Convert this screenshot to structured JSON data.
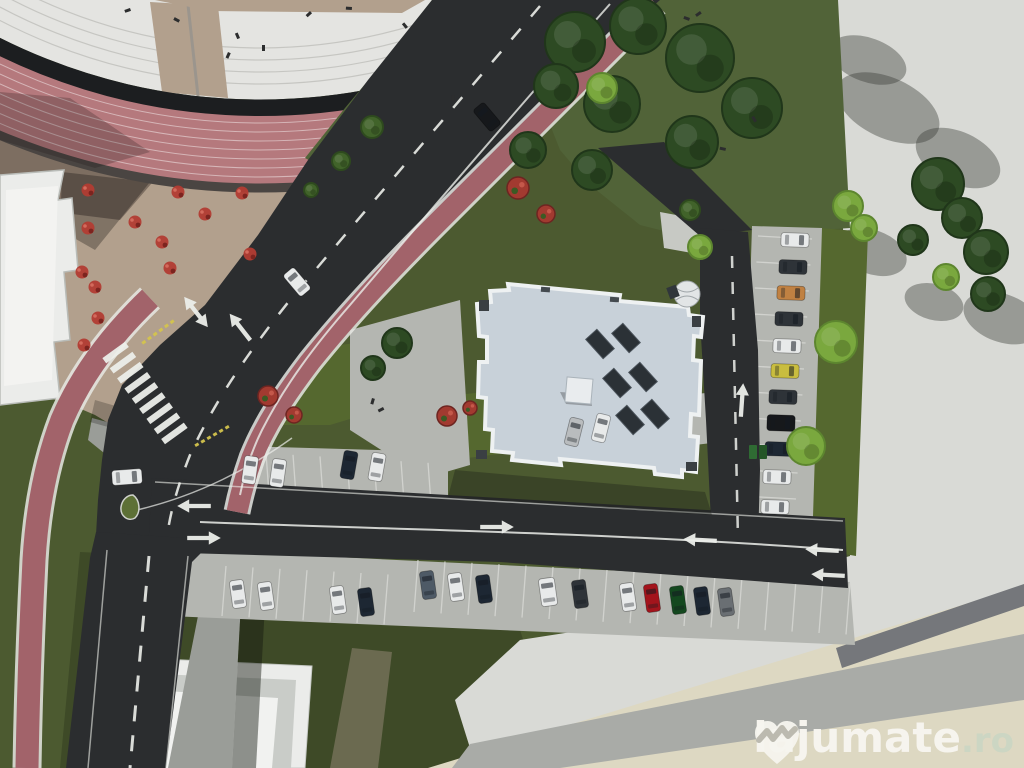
{
  "watermark": {
    "brand": "lajumate",
    "tld": ".ro",
    "logo": "heart-zigzag-icon"
  },
  "palette": {
    "base_grass": "#4c5a30",
    "lawn_dark": "#3e4a27",
    "grass_mid": "#55682f",
    "grass_strip": "#516338",
    "tree_dark": "#2d4a23",
    "tree_mid": "#41632a",
    "tree_light": "#7aa83e",
    "bush_red": "#a23a30",
    "road": "#2b2d2f",
    "bike_red": "#a2636a",
    "track_pink": "#b5797d",
    "track_line": "#d6b6b8",
    "tan": "#b2a08d",
    "steps_white": "#e4e4e1",
    "step_line": "#c6c6c2",
    "ring_black": "#1c1e20",
    "curb": "#4a4542",
    "paving": "#b4b6b1",
    "paving_light": "#c7c9c4",
    "sidewalk": "#9a9d98",
    "concrete": "#d9dad6",
    "cream": "#ddd8c2",
    "band_gray": "#a9aba7",
    "band_dark": "#75777b",
    "bldg_white": "#ebecea",
    "bldg_frame": "#c9ccc8",
    "roof": "#c8d1d9",
    "roof_edge": "#eef1f2",
    "panel": "#2b3136",
    "mark_white": "#eceeea",
    "mark_yellow": "#d4c44d",
    "car_white": "#e8eaea",
    "car_silver": "#b9bcbe",
    "car_black": "#16181b",
    "car_charcoal": "#2e3338",
    "car_navy": "#1d2733",
    "car_steel": "#4e5a66",
    "car_red": "#a3141c",
    "car_green": "#14481f",
    "car_gray": "#6a6f73",
    "car_yellow": "#c9bd3f",
    "car_orange": "#c08142",
    "wm_white": "#f6f4ee",
    "wm_ro": "#ccd6c3"
  },
  "scene": {
    "vehicles": [
      {
        "x": 297,
        "y": 282,
        "rot": -40,
        "color": "car_white"
      },
      {
        "x": 487,
        "y": 117,
        "rot": -40,
        "color": "car_black"
      },
      {
        "x": 127,
        "y": 477,
        "rot": 86,
        "color": "car_white",
        "len": 30,
        "wid": 15
      },
      {
        "x": 250,
        "y": 470,
        "rot": 8,
        "color": "car_white"
      },
      {
        "x": 278,
        "y": 473,
        "rot": 8,
        "color": "car_white"
      },
      {
        "x": 349,
        "y": 465,
        "rot": 10,
        "color": "car_navy"
      },
      {
        "x": 377,
        "y": 467,
        "rot": 10,
        "color": "car_white"
      },
      {
        "x": 574,
        "y": 432,
        "rot": 14,
        "color": "car_silver"
      },
      {
        "x": 601,
        "y": 428,
        "rot": 14,
        "color": "car_white"
      },
      {
        "x": 238,
        "y": 594,
        "rot": -8,
        "color": "car_white"
      },
      {
        "x": 266,
        "y": 596,
        "rot": -8,
        "color": "car_white"
      },
      {
        "x": 338,
        "y": 600,
        "rot": -8,
        "color": "car_white"
      },
      {
        "x": 366,
        "y": 602,
        "rot": -8,
        "color": "car_navy"
      },
      {
        "x": 428,
        "y": 585,
        "rot": -8,
        "color": "car_steel"
      },
      {
        "x": 456,
        "y": 587,
        "rot": -8,
        "color": "car_white"
      },
      {
        "x": 484,
        "y": 589,
        "rot": -8,
        "color": "car_navy"
      },
      {
        "x": 548,
        "y": 592,
        "rot": -8,
        "color": "car_white",
        "wid": 16
      },
      {
        "x": 580,
        "y": 594,
        "rot": -8,
        "color": "car_charcoal"
      },
      {
        "x": 628,
        "y": 597,
        "rot": -8,
        "color": "car_white"
      },
      {
        "x": 652,
        "y": 598,
        "rot": -8,
        "color": "car_red"
      },
      {
        "x": 678,
        "y": 600,
        "rot": -8,
        "color": "car_green"
      },
      {
        "x": 702,
        "y": 601,
        "rot": -8,
        "color": "car_navy"
      },
      {
        "x": 726,
        "y": 602,
        "rot": -8,
        "color": "car_gray"
      },
      {
        "x": 795,
        "y": 240,
        "rot": 92,
        "color": "car_white"
      },
      {
        "x": 793,
        "y": 267,
        "rot": 92,
        "color": "car_charcoal"
      },
      {
        "x": 791,
        "y": 293,
        "rot": 92,
        "color": "car_orange"
      },
      {
        "x": 789,
        "y": 319,
        "rot": 92,
        "color": "car_charcoal"
      },
      {
        "x": 787,
        "y": 346,
        "rot": 92,
        "color": "car_white"
      },
      {
        "x": 785,
        "y": 371,
        "rot": 92,
        "color": "car_yellow"
      },
      {
        "x": 783,
        "y": 397,
        "rot": 92,
        "color": "car_charcoal"
      },
      {
        "x": 781,
        "y": 423,
        "rot": 92,
        "color": "car_black",
        "wid": 16
      },
      {
        "x": 779,
        "y": 449,
        "rot": 92,
        "color": "car_navy"
      },
      {
        "x": 777,
        "y": 477,
        "rot": 92,
        "color": "car_white"
      },
      {
        "x": 775,
        "y": 507,
        "rot": 92,
        "color": "car_white"
      },
      {
        "x": 758,
        "y": 452,
        "rot": 0,
        "color": "bin"
      }
    ],
    "trees": [
      {
        "x": 575,
        "y": 42,
        "r": 30,
        "shade": "dark"
      },
      {
        "x": 638,
        "y": 26,
        "r": 28,
        "shade": "dark"
      },
      {
        "x": 700,
        "y": 58,
        "r": 34,
        "shade": "dark"
      },
      {
        "x": 752,
        "y": 108,
        "r": 30,
        "shade": "dark"
      },
      {
        "x": 692,
        "y": 142,
        "r": 26,
        "shade": "dark"
      },
      {
        "x": 612,
        "y": 104,
        "r": 28,
        "shade": "dark"
      },
      {
        "x": 556,
        "y": 86,
        "r": 22,
        "shade": "dark"
      },
      {
        "x": 528,
        "y": 150,
        "r": 18,
        "shade": "dark"
      },
      {
        "x": 592,
        "y": 170,
        "r": 20,
        "shade": "dark"
      },
      {
        "x": 938,
        "y": 184,
        "r": 26,
        "shade": "dark"
      },
      {
        "x": 962,
        "y": 218,
        "r": 20,
        "shade": "dark"
      },
      {
        "x": 986,
        "y": 252,
        "r": 22,
        "shade": "dark"
      },
      {
        "x": 913,
        "y": 240,
        "r": 15,
        "shade": "dark"
      },
      {
        "x": 988,
        "y": 294,
        "r": 17,
        "shade": "dark"
      },
      {
        "x": 397,
        "y": 343,
        "r": 15,
        "shade": "dark"
      },
      {
        "x": 373,
        "y": 368,
        "r": 12,
        "shade": "dark"
      },
      {
        "x": 372,
        "y": 127,
        "r": 11,
        "shade": "mid"
      },
      {
        "x": 341,
        "y": 161,
        "r": 9,
        "shade": "mid"
      },
      {
        "x": 311,
        "y": 190,
        "r": 7,
        "shade": "mid"
      },
      {
        "x": 690,
        "y": 210,
        "r": 10,
        "shade": "mid"
      },
      {
        "x": 602,
        "y": 88,
        "r": 15,
        "shade": "light"
      },
      {
        "x": 848,
        "y": 206,
        "r": 15,
        "shade": "light"
      },
      {
        "x": 864,
        "y": 228,
        "r": 13,
        "shade": "light"
      },
      {
        "x": 836,
        "y": 342,
        "r": 21,
        "shade": "light"
      },
      {
        "x": 806,
        "y": 446,
        "r": 19,
        "shade": "light"
      },
      {
        "x": 700,
        "y": 247,
        "r": 12,
        "shade": "light"
      },
      {
        "x": 946,
        "y": 277,
        "r": 13,
        "shade": "light"
      }
    ],
    "bushes": [
      {
        "x": 518,
        "y": 188,
        "r": 11
      },
      {
        "x": 546,
        "y": 214,
        "r": 9
      },
      {
        "x": 268,
        "y": 396,
        "r": 10
      },
      {
        "x": 294,
        "y": 415,
        "r": 8
      },
      {
        "x": 447,
        "y": 416,
        "r": 10
      },
      {
        "x": 470,
        "y": 408,
        "r": 7
      }
    ],
    "cafe_tables": [
      {
        "x": 88,
        "y": 190
      },
      {
        "x": 178,
        "y": 192
      },
      {
        "x": 242,
        "y": 193
      },
      {
        "x": 135,
        "y": 222
      },
      {
        "x": 205,
        "y": 214
      },
      {
        "x": 162,
        "y": 242
      },
      {
        "x": 88,
        "y": 228
      },
      {
        "x": 82,
        "y": 272
      },
      {
        "x": 95,
        "y": 287
      },
      {
        "x": 170,
        "y": 268
      },
      {
        "x": 250,
        "y": 254
      },
      {
        "x": 98,
        "y": 318
      },
      {
        "x": 84,
        "y": 345
      }
    ],
    "people": [
      {
        "x": 262,
        "y": 45
      },
      {
        "x": 310,
        "y": 11
      },
      {
        "x": 352,
        "y": 7
      },
      {
        "x": 408,
        "y": 27
      },
      {
        "x": 452,
        "y": 95
      },
      {
        "x": 700,
        "y": 11
      },
      {
        "x": 726,
        "y": 148
      },
      {
        "x": 757,
        "y": 121
      },
      {
        "x": 372,
        "y": 398
      },
      {
        "x": 383,
        "y": 407
      },
      {
        "x": 690,
        "y": 18
      },
      {
        "x": 240,
        "y": 38
      },
      {
        "x": 228,
        "y": 52
      },
      {
        "x": 130,
        "y": 8
      },
      {
        "x": 180,
        "y": 20
      }
    ],
    "tree_shadows": [
      {
        "x": 888,
        "y": 108,
        "rx": 55,
        "ry": 30,
        "rot": 25
      },
      {
        "x": 958,
        "y": 158,
        "rx": 45,
        "ry": 26,
        "rot": 25
      },
      {
        "x": 1002,
        "y": 318,
        "rx": 40,
        "ry": 24,
        "rot": 20
      },
      {
        "x": 872,
        "y": 252,
        "rx": 36,
        "ry": 22,
        "rot": 20
      },
      {
        "x": 934,
        "y": 302,
        "rx": 30,
        "ry": 18,
        "rot": 15
      },
      {
        "x": 868,
        "y": 60,
        "rx": 40,
        "ry": 22,
        "rot": 20
      }
    ],
    "roof_panels": [
      {
        "x": 600,
        "y": 344
      },
      {
        "x": 626,
        "y": 338
      },
      {
        "x": 617,
        "y": 383
      },
      {
        "x": 643,
        "y": 377
      },
      {
        "x": 630,
        "y": 420
      },
      {
        "x": 655,
        "y": 414
      }
    ],
    "arrows": [
      {
        "x": 196,
        "y": 312,
        "rot": -38,
        "type": "double"
      },
      {
        "x": 240,
        "y": 327,
        "rot": -38,
        "type": "up"
      },
      {
        "x": 194,
        "y": 506,
        "rot": -90,
        "type": "up"
      },
      {
        "x": 204,
        "y": 538,
        "rot": 90,
        "type": "up"
      },
      {
        "x": 497,
        "y": 527,
        "rot": 90,
        "type": "up"
      },
      {
        "x": 700,
        "y": 540,
        "rot": -87,
        "type": "up"
      },
      {
        "x": 822,
        "y": 550,
        "rot": -87,
        "type": "up"
      },
      {
        "x": 828,
        "y": 575,
        "rot": -87,
        "type": "up"
      },
      {
        "x": 742,
        "y": 400,
        "rot": 4,
        "type": "up"
      }
    ],
    "stall_groups": [
      {
        "x": 212,
        "y": 450,
        "sx": 27,
        "sy": 1.6,
        "vx": 4,
        "vy": 54,
        "n": 9
      },
      {
        "x": 553,
        "y": 418,
        "sx": 27,
        "sy": -3,
        "vx": 4,
        "vy": 48,
        "n": 7
      },
      {
        "x": 226,
        "y": 566,
        "sx": 27,
        "sy": 1.4,
        "vx": -4,
        "vy": 50,
        "n": 7
      },
      {
        "x": 418,
        "y": 560,
        "sx": 27,
        "sy": 1.4,
        "vx": -4,
        "vy": 52,
        "n": 17
      },
      {
        "x": 758,
        "y": 236,
        "sx": -1.6,
        "sy": 26,
        "vx": 54,
        "vy": 3,
        "n": 13
      }
    ],
    "crosswalk": {
      "x": 145,
      "y": 393,
      "rot": -36,
      "stripes": 9,
      "len": 28,
      "gap": 12.5,
      "h": 6.5
    },
    "yellow_dashes": [
      {
        "x": 158,
        "y": 332,
        "rot": -36,
        "n": 6
      },
      {
        "x": 212,
        "y": 436,
        "rot": -30,
        "n": 6
      }
    ]
  }
}
